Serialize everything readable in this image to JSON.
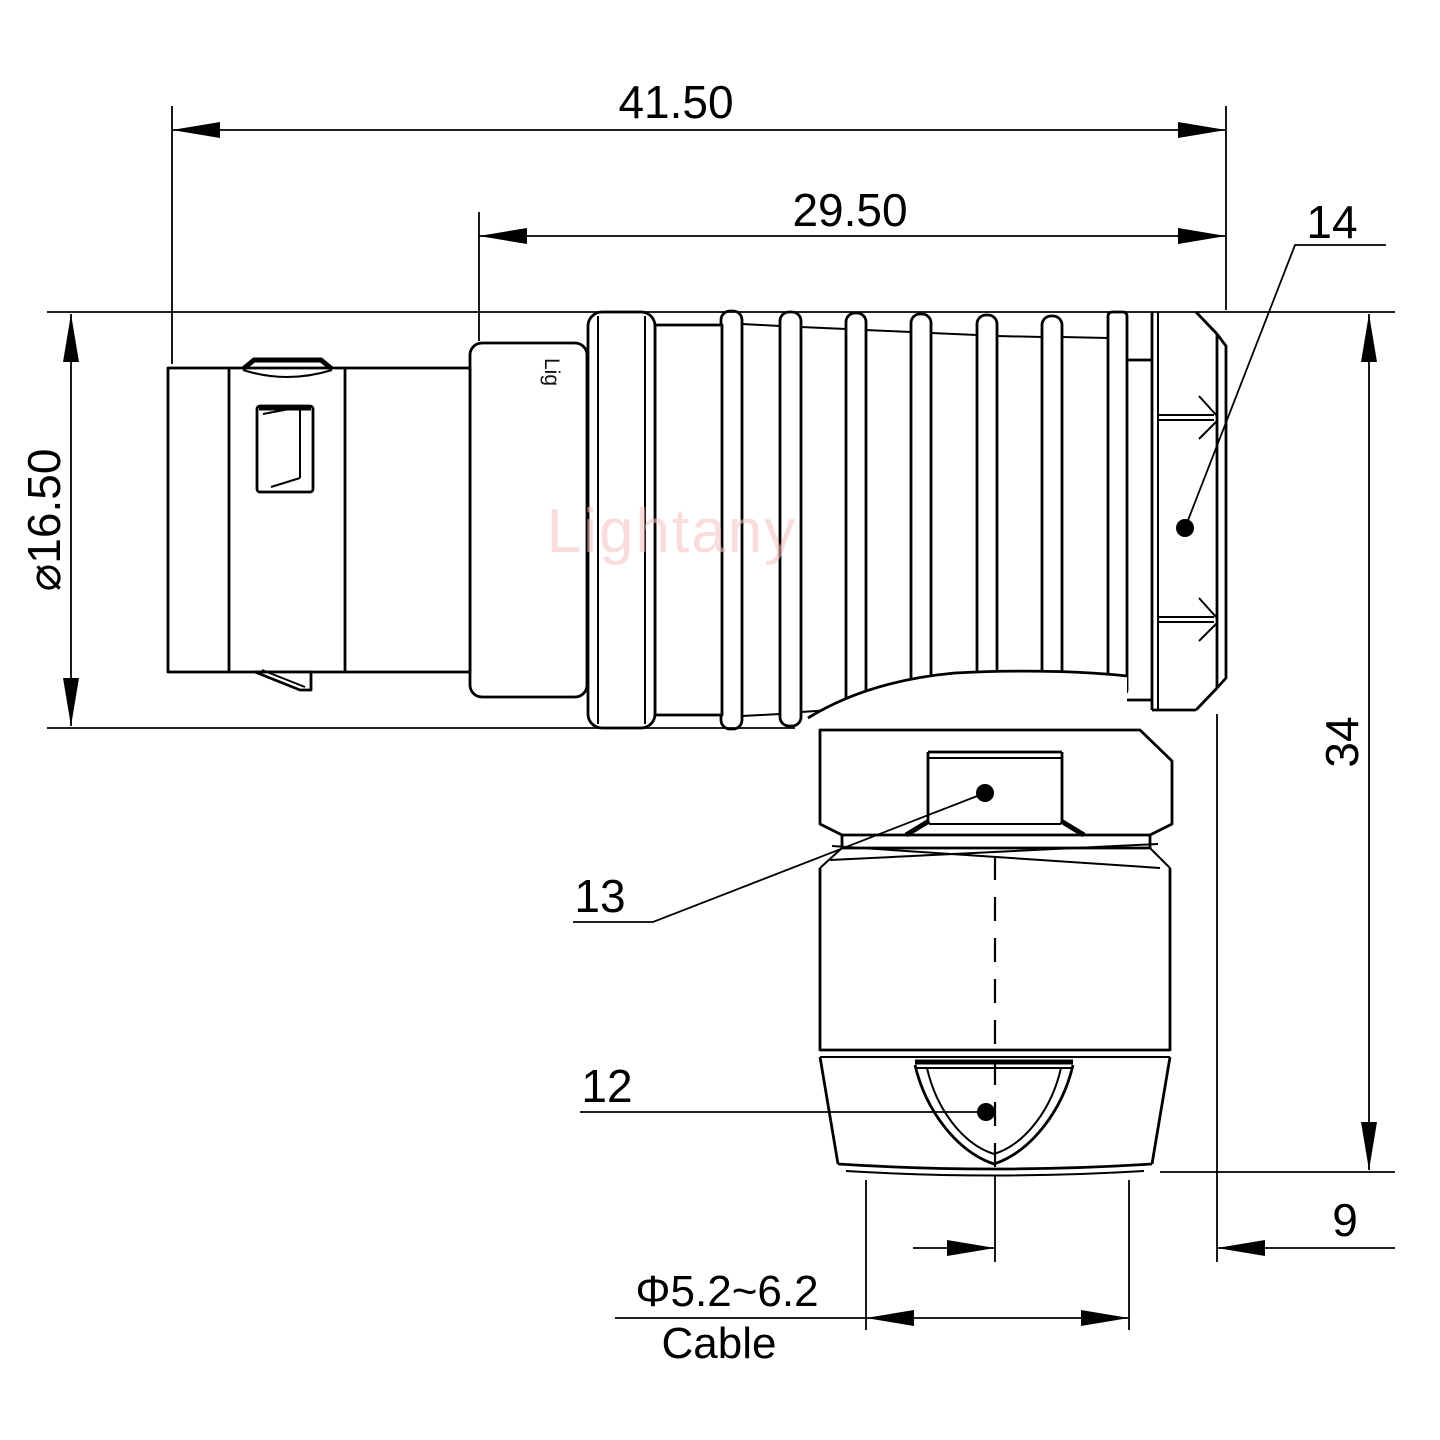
{
  "drawing": {
    "watermark": "Lightany",
    "shell_marking": "Lig",
    "dimensions": {
      "overall_length": "41.50",
      "barrel_length": "29.50",
      "shell_diameter": "⌀16.50",
      "overall_height": "34",
      "axis_to_rear": "9",
      "cable_diameter": "Φ5.2~6.2",
      "cable_label": "Cable"
    },
    "part_labels": {
      "back_nut": "14",
      "coupling_hex": "13",
      "strain_relief": "12"
    },
    "colors": {
      "line": "#000000",
      "watermark": "#f5c2c3",
      "background": "#ffffff"
    }
  }
}
